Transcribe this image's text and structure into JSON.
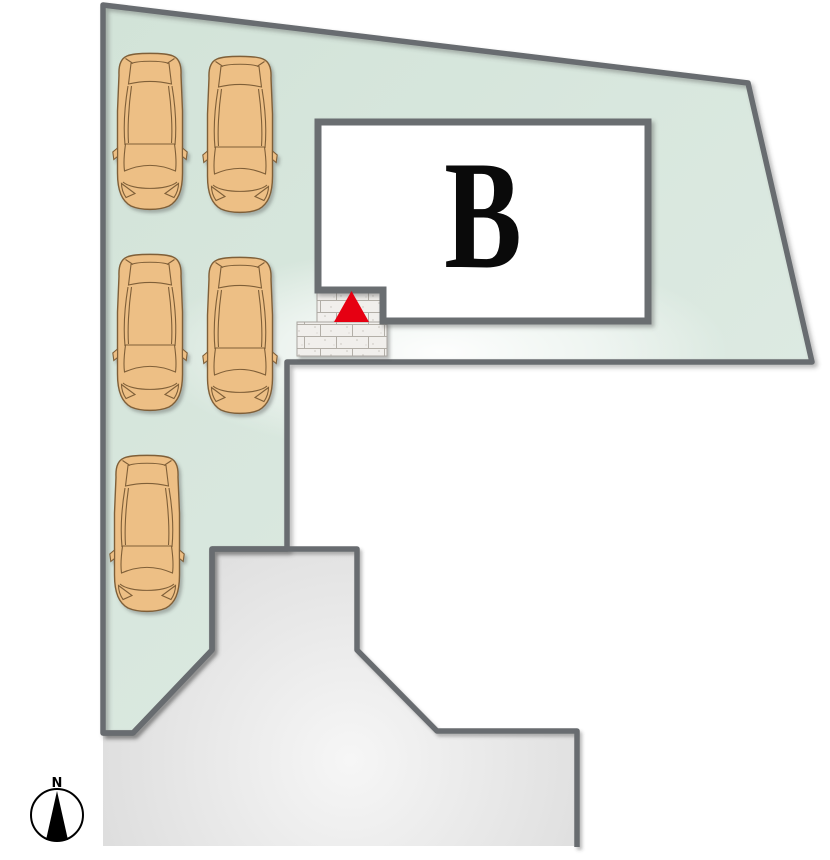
{
  "site_plan": {
    "building": {
      "label": "B"
    },
    "compass": {
      "north_label": "N"
    },
    "parking": {
      "car_count": 5
    }
  },
  "colors": {
    "plot_green": "#d2e3d8",
    "plot_green_light": "#e3efe8",
    "boundary_gray": "#686c6f",
    "road_gray": "#dbdbdb",
    "road_gray_light": "#f6f6f6",
    "building_fill": "#ffffff",
    "building_border": "#6a6e71",
    "entrance_marker_red": "#e60012",
    "car_body": "#edbf85",
    "car_outline": "#7f5f38",
    "step_fill": "#f1efec",
    "step_line": "#b3afa8",
    "compass_black": "#000000"
  },
  "shapes": {
    "plot_points": "103,5 748,83 812,362 287,362 287,549 212,549 212,650 133,733 103,733",
    "road_fill_path": "M103,846 L103,733 L133,733 L212,650 L212,549 L357,549 L357,650 L437,731 L577,731 L577,846 Z",
    "road_border_path": "M103,733 L133,733 L212,650 L212,549 L357,549 L357,650 L437,731 L577,731 L577,847",
    "building_path": "M318,122 L648,122 L648,321 L383,321 L383,290 L318,290 Z",
    "step_upper_path": "M317,283 L384,283 L384,322 L317,322 Z",
    "step_lower_path": "M297,322 L387,322 L387,356 L297,356 Z",
    "entrance_marker_points": "351.5,291 369,322 334,322",
    "compass_needle_points": "57,791 68,840 46,840"
  },
  "cars": {
    "count": 5,
    "positions": [
      "translate(112,51)",
      "translate(202,54)",
      "translate(112,252)",
      "translate(202,255)",
      "translate(109,453)"
    ]
  }
}
